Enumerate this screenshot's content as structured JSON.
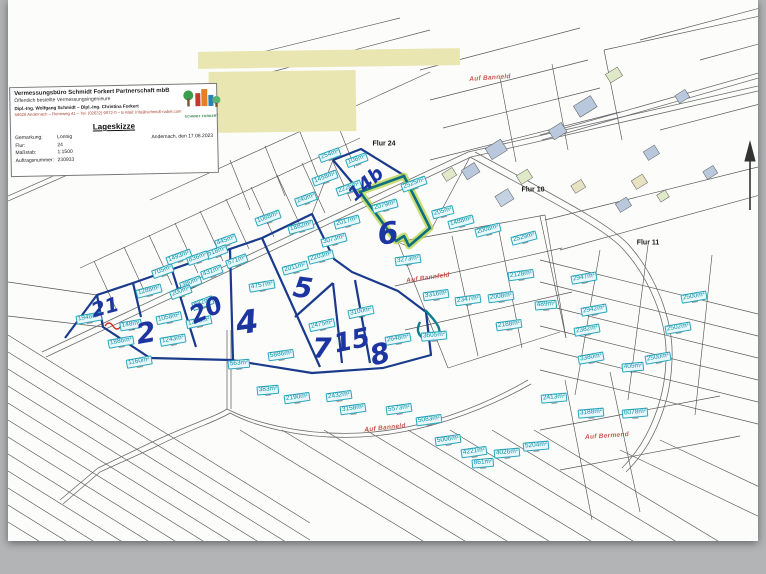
{
  "titleblock": {
    "company": "Vermessungsbüro Schmidt Forkert Partnerschaft mbB",
    "subtitle": "Öffentlich bestellte Vermessungsingenieure",
    "engineers": "Dipl.-Ing. Wolfgang Schmidt  –  Dipl.-Ing. Christina Forkert",
    "contact": "56626 Andernach – Rennweg 41 – Tel. (02632) 9072-0 – E-Mail: info@schmidt-nabel.com",
    "logo_caption": "SCHMIDT FORKERT",
    "doc_title": "Lageskizze",
    "fields": [
      {
        "label": "Gemarkung:",
        "value": "Lonnig"
      },
      {
        "label": "Flur:",
        "value": "24"
      },
      {
        "label": "Maßstab:",
        "value": "1:1500"
      },
      {
        "label": "Auftragsnummer:",
        "value": "230933"
      }
    ],
    "date_line": "Andernach, den 17.08.2023"
  },
  "map": {
    "flur_labels": [
      {
        "text": "Flur 24",
        "x": 384,
        "y": 144
      },
      {
        "text": "Flur 10",
        "x": 533,
        "y": 190
      },
      {
        "text": "Flur 11",
        "x": 648,
        "y": 243
      }
    ],
    "street_labels": [
      {
        "text": "Auf Banneld",
        "x": 490,
        "y": 78,
        "r": -4
      },
      {
        "text": "Auf Bannfeld",
        "x": 428,
        "y": 278,
        "r": -8
      },
      {
        "text": "Auf Banneld",
        "x": 385,
        "y": 428,
        "r": -6
      },
      {
        "text": "Auf Bermend",
        "x": 607,
        "y": 436,
        "r": -4
      }
    ],
    "handwritten": [
      {
        "text": "21",
        "x": 105,
        "y": 307,
        "s": 20,
        "r": -15
      },
      {
        "text": "2",
        "x": 146,
        "y": 333,
        "s": 28,
        "r": -10
      },
      {
        "text": "20",
        "x": 206,
        "y": 310,
        "s": 24,
        "r": -25
      },
      {
        "text": "4",
        "x": 247,
        "y": 322,
        "s": 32,
        "r": -8
      },
      {
        "text": "5",
        "x": 303,
        "y": 288,
        "s": 28,
        "r": 8
      },
      {
        "text": "7",
        "x": 322,
        "y": 348,
        "s": 28,
        "r": 0
      },
      {
        "text": "15",
        "x": 352,
        "y": 341,
        "s": 26,
        "r": -12
      },
      {
        "text": "8",
        "x": 380,
        "y": 354,
        "s": 28,
        "r": -15
      },
      {
        "text": "6",
        "x": 388,
        "y": 234,
        "s": 30,
        "r": -8
      },
      {
        "text": "14b",
        "x": 366,
        "y": 184,
        "s": 19,
        "r": -42
      }
    ],
    "area_labels": [
      {
        "text": "254m²",
        "x": 330,
        "y": 155,
        "r": -20
      },
      {
        "text": "108m²",
        "x": 357,
        "y": 160,
        "r": -20
      },
      {
        "text": "1458m²",
        "x": 325,
        "y": 178,
        "r": -20
      },
      {
        "text": "2226m²",
        "x": 349,
        "y": 188,
        "r": -20
      },
      {
        "text": "2525m²",
        "x": 414,
        "y": 184,
        "r": -20
      },
      {
        "text": "2079m²",
        "x": 385,
        "y": 206,
        "r": -15
      },
      {
        "text": "205m²",
        "x": 443,
        "y": 212,
        "r": -15
      },
      {
        "text": "1488m²",
        "x": 461,
        "y": 222,
        "r": -15
      },
      {
        "text": "2008m²",
        "x": 488,
        "y": 230,
        "r": -15
      },
      {
        "text": "2529m²",
        "x": 524,
        "y": 238,
        "r": -15
      },
      {
        "text": "240m²",
        "x": 306,
        "y": 199,
        "r": -20
      },
      {
        "text": "1088m²",
        "x": 268,
        "y": 218,
        "r": -20
      },
      {
        "text": "1882m²",
        "x": 301,
        "y": 227,
        "r": -15
      },
      {
        "text": "2017m²",
        "x": 347,
        "y": 222,
        "r": -15
      },
      {
        "text": "445m²",
        "x": 226,
        "y": 241,
        "r": -20
      },
      {
        "text": "518m²",
        "x": 217,
        "y": 252,
        "r": -20
      },
      {
        "text": "1493m²",
        "x": 179,
        "y": 257,
        "r": -20
      },
      {
        "text": "836m²",
        "x": 198,
        "y": 258,
        "r": -20
      },
      {
        "text": "571m²",
        "x": 237,
        "y": 261,
        "r": -20
      },
      {
        "text": "705m²",
        "x": 163,
        "y": 271,
        "r": -20
      },
      {
        "text": "431m²",
        "x": 212,
        "y": 272,
        "r": -20
      },
      {
        "text": "380m²",
        "x": 191,
        "y": 283,
        "r": -20
      },
      {
        "text": "200m²",
        "x": 181,
        "y": 292,
        "r": -20
      },
      {
        "text": "832m²",
        "x": 203,
        "y": 303,
        "r": -20
      },
      {
        "text": "3073m²",
        "x": 334,
        "y": 240,
        "r": -15
      },
      {
        "text": "2203m²",
        "x": 321,
        "y": 257,
        "r": -15
      },
      {
        "text": "2011m²",
        "x": 295,
        "y": 268,
        "r": -15
      },
      {
        "text": "4757m²",
        "x": 262,
        "y": 286,
        "r": -10
      },
      {
        "text": "1948m²",
        "x": 89,
        "y": 318,
        "r": -10
      },
      {
        "text": "1288m²",
        "x": 149,
        "y": 291,
        "r": -15
      },
      {
        "text": "148m²",
        "x": 131,
        "y": 325,
        "r": -10
      },
      {
        "text": "1058m²",
        "x": 169,
        "y": 318,
        "r": -12
      },
      {
        "text": "1253m²",
        "x": 199,
        "y": 322,
        "r": -12
      },
      {
        "text": "1886m²",
        "x": 121,
        "y": 342,
        "r": -10
      },
      {
        "text": "1243m²",
        "x": 173,
        "y": 340,
        "r": -10
      },
      {
        "text": "1160m²",
        "x": 139,
        "y": 362,
        "r": -10
      },
      {
        "text": "563m²",
        "x": 239,
        "y": 364,
        "r": -5
      },
      {
        "text": "2475m²",
        "x": 322,
        "y": 325,
        "r": -12
      },
      {
        "text": "3100m²",
        "x": 361,
        "y": 312,
        "r": -12
      },
      {
        "text": "2648m²",
        "x": 398,
        "y": 339,
        "r": -10
      },
      {
        "text": "5886m²",
        "x": 281,
        "y": 355,
        "r": -8
      },
      {
        "text": "383m²",
        "x": 268,
        "y": 390,
        "r": -5
      },
      {
        "text": "2190m²",
        "x": 297,
        "y": 398,
        "r": -8
      },
      {
        "text": "2432m²",
        "x": 339,
        "y": 396,
        "r": -8
      },
      {
        "text": "3158m²",
        "x": 353,
        "y": 409,
        "r": -8
      },
      {
        "text": "5573m²",
        "x": 399,
        "y": 409,
        "r": -8
      },
      {
        "text": "5083m²",
        "x": 429,
        "y": 420,
        "r": -8
      },
      {
        "text": "5006m²",
        "x": 448,
        "y": 440,
        "r": -8
      },
      {
        "text": "4221m²",
        "x": 474,
        "y": 452,
        "r": -8
      },
      {
        "text": "861m²",
        "x": 483,
        "y": 463,
        "r": -5
      },
      {
        "text": "5204m²",
        "x": 536,
        "y": 446,
        "r": -5
      },
      {
        "text": "4026m²",
        "x": 507,
        "y": 453,
        "r": -5
      },
      {
        "text": "2413m²",
        "x": 554,
        "y": 398,
        "r": -5
      },
      {
        "text": "3188m²",
        "x": 591,
        "y": 413,
        "r": -5
      },
      {
        "text": "6078m²",
        "x": 635,
        "y": 413,
        "r": -5
      },
      {
        "text": "3273m²",
        "x": 408,
        "y": 260,
        "r": -8
      },
      {
        "text": "3316m²",
        "x": 436,
        "y": 295,
        "r": -8
      },
      {
        "text": "2347m²",
        "x": 468,
        "y": 300,
        "r": -8
      },
      {
        "text": "2008m²",
        "x": 501,
        "y": 297,
        "r": -8
      },
      {
        "text": "2128m²",
        "x": 521,
        "y": 275,
        "r": -8
      },
      {
        "text": "2188m²",
        "x": 509,
        "y": 325,
        "r": -8
      },
      {
        "text": "489m²",
        "x": 546,
        "y": 305,
        "r": -5
      },
      {
        "text": "3605m²",
        "x": 434,
        "y": 336,
        "r": -5
      },
      {
        "text": "2947m²",
        "x": 584,
        "y": 278,
        "r": -10
      },
      {
        "text": "2500m²",
        "x": 694,
        "y": 297,
        "r": -10
      },
      {
        "text": "2942m²",
        "x": 594,
        "y": 310,
        "r": -10
      },
      {
        "text": "2382m²",
        "x": 587,
        "y": 330,
        "r": -10
      },
      {
        "text": "2502m²",
        "x": 678,
        "y": 328,
        "r": -10
      },
      {
        "text": "3380m²",
        "x": 591,
        "y": 358,
        "r": -10
      },
      {
        "text": "2500m²",
        "x": 658,
        "y": 358,
        "r": -10
      },
      {
        "text": "405m²",
        "x": 633,
        "y": 367,
        "r": -5
      }
    ]
  }
}
